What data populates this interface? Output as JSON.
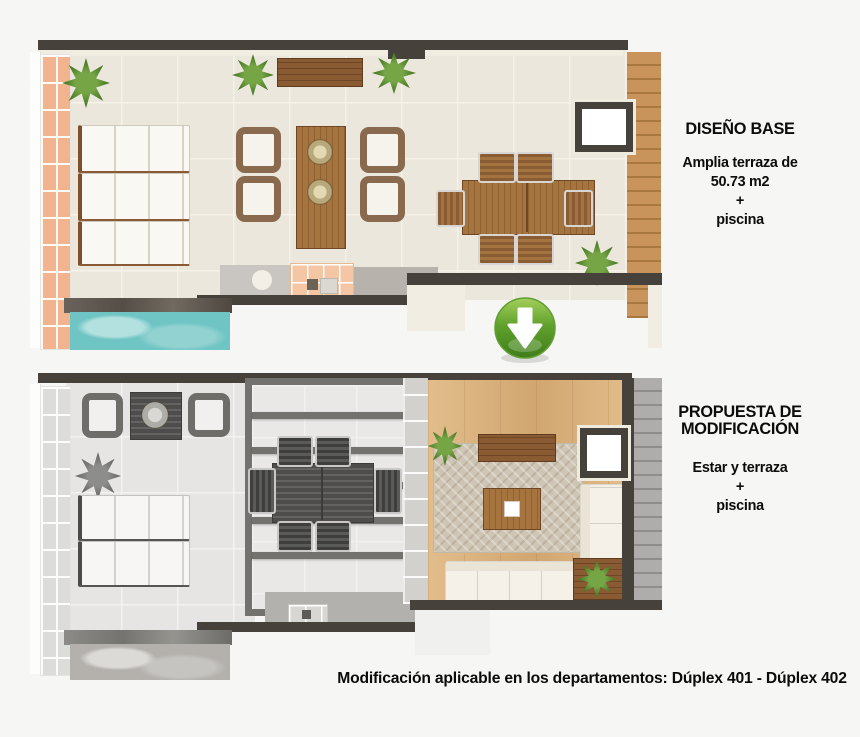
{
  "page": {
    "background_color": "#f6f6f5"
  },
  "top_panel": {
    "title": "DISEÑO BASE",
    "description_lines": [
      "Amplia terraza de",
      "50.73 m2",
      "+",
      "piscina"
    ]
  },
  "bottom_panel": {
    "title": "PROPUESTA DE MODIFICACIÓN",
    "description_lines": [
      "Estar y terraza",
      "+",
      "piscina"
    ]
  },
  "footer": {
    "note": "Modificación aplicable en los departamentos: Dúplex 401 - Dúplex 402"
  },
  "arrow_icon": {
    "direction": "down",
    "color": "#4e9423"
  },
  "colors": {
    "wall_dark": "#46413b",
    "terrace_tile": "#ece7dc",
    "louver_peach": "#f1b48e",
    "pool_turquoise": "#6fc5c4",
    "wood_brown": "#8a5a33",
    "arrow_green": "#4e9423",
    "text_black": "#0c0c0c"
  }
}
